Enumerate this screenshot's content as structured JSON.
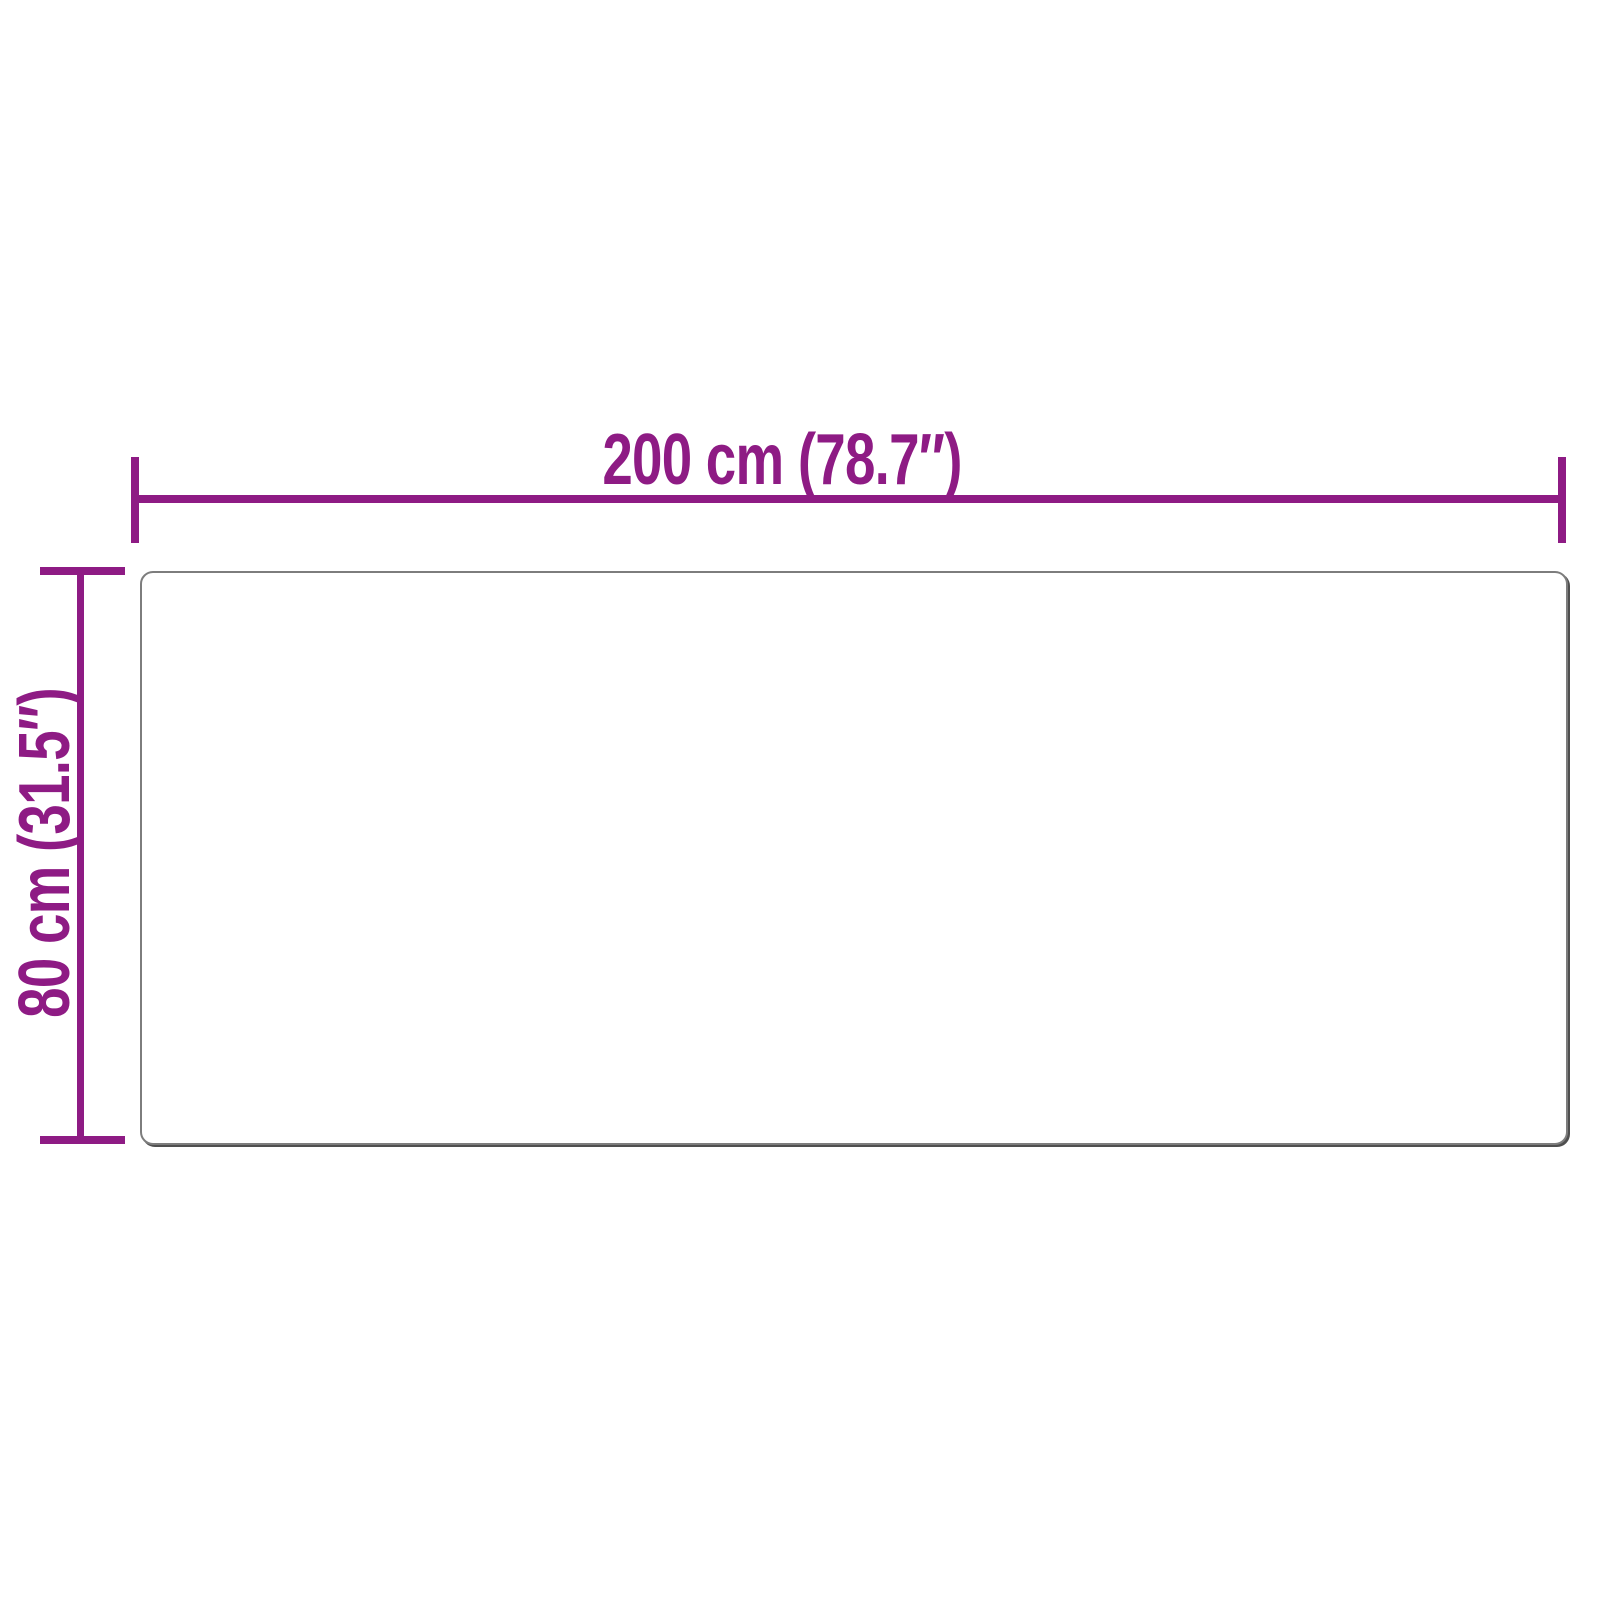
{
  "diagram": {
    "width_label": "200 cm (78.7″)",
    "height_label": "80 cm (31.5″)",
    "colors": {
      "accent": "#8e1b84",
      "outline": "#7d7d7d",
      "outline_shadow": "#4f4f4f",
      "background": "#ffffff"
    }
  }
}
